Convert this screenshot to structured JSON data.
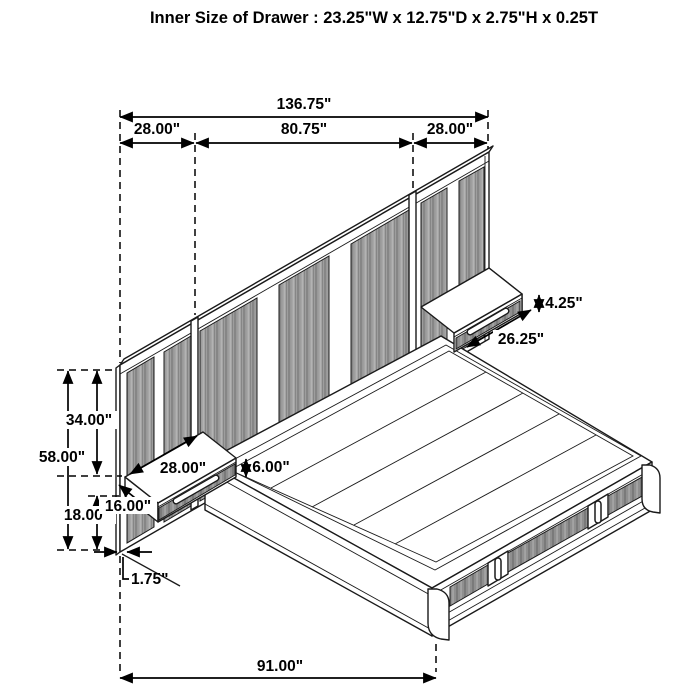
{
  "title": "Inner Size of Drawer : 23.25\"W x 12.75\"D x 2.75\"H x 0.25T",
  "dimensions": {
    "overall_width": "136.75\"",
    "left_panel_width": "28.00\"",
    "center_panel_width": "80.75\"",
    "right_panel_width": "28.00\"",
    "panel_height": "58.00\"",
    "panel_top_to_nightstand": "34.00\"",
    "nightstand_to_floor": "18.00\"",
    "nightstand_depth": "16.00\"",
    "nightstand_width": "28.00\"",
    "nightstand_height": "6.00\"",
    "drawer_front_height": "4.25\"",
    "drawer_front_width": "26.25\"",
    "panel_thickness": "1.75\"",
    "bed_length": "91.00\""
  },
  "colors": {
    "line": "#1a1a1a",
    "background": "#ffffff",
    "plank_mid": "#9e9e9e",
    "plank_dark": "#868686",
    "plank_light": "#b3b3b3",
    "drawer_mid": "#8f8f8f",
    "drawer_dark": "#7a7a7a",
    "drawer_light": "#a8a8a8"
  }
}
